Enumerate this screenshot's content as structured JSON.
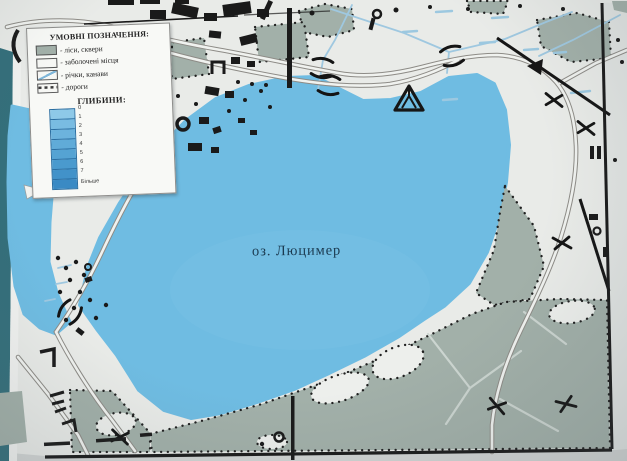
{
  "sign": {
    "lake_label": "оз. Люцимер",
    "legend": {
      "title": "УМОВНІ ПОЗНАЧЕННЯ:",
      "items": [
        {
          "id": "forest",
          "label": "- ліси, сквери"
        },
        {
          "id": "swamp",
          "label": "- заболочені місця"
        },
        {
          "id": "river",
          "label": "- річки, канави"
        },
        {
          "id": "road",
          "label": "- дороги"
        }
      ],
      "depths_title": "ГЛИБИНИ:",
      "depth_scale_labels": [
        "0",
        "1",
        "2",
        "3",
        "4",
        "5",
        "6",
        "7",
        "Більше"
      ]
    },
    "colors": {
      "lake": "#6fbce2",
      "forest": "#a2b0a9",
      "paper": "#e9ebe8",
      "board_edge": "#346f7b",
      "frame": "#1a1a1a"
    }
  }
}
